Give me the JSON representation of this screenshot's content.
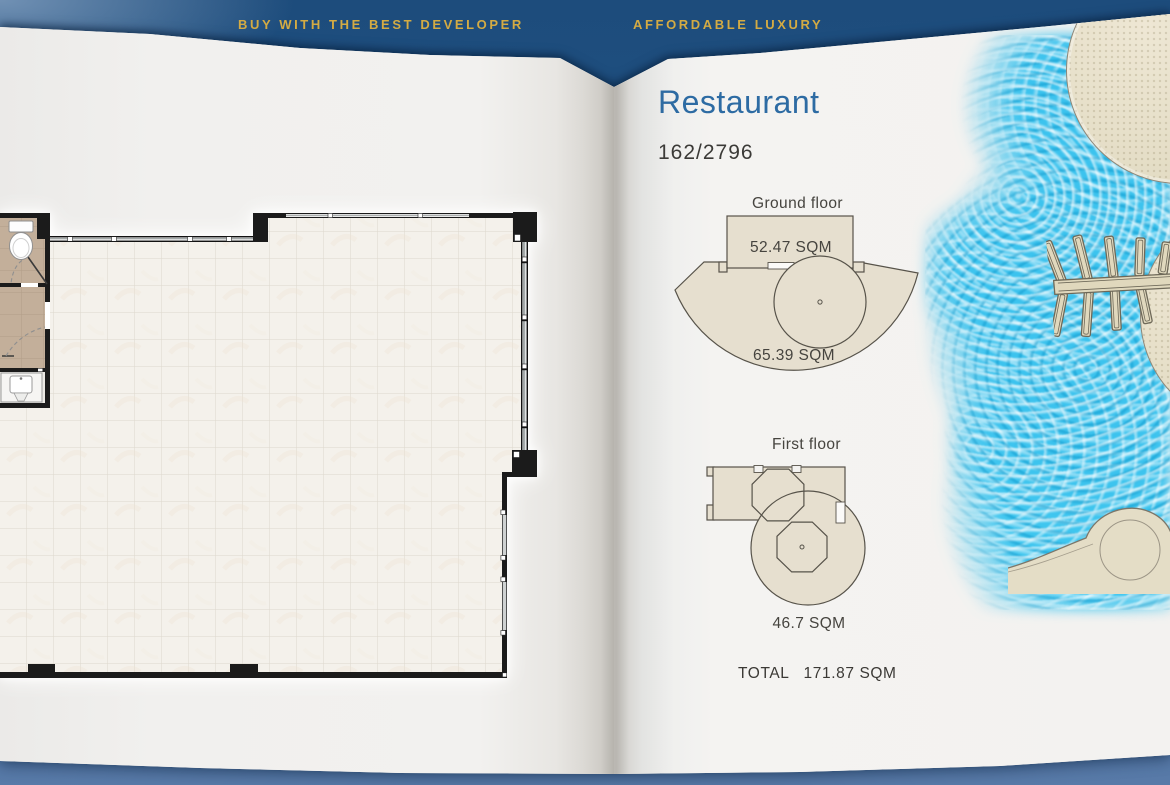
{
  "header": {
    "left_slogan": "BUY WITH THE BEST DEVELOPER",
    "right_slogan": "AFFORDABLE LUXURY"
  },
  "right_page": {
    "title": "Restaurant",
    "unit_number": "162/2796",
    "ground_floor": {
      "label": "Ground floor",
      "upper_area": "52.47 SQM",
      "lower_area": "65.39 SQM"
    },
    "first_floor": {
      "label": "First floor",
      "area": "46.7 SQM"
    },
    "total": {
      "label": "TOTAL",
      "value": "171.87 SQM"
    }
  },
  "left_page": {
    "content": "restaurant unit floor plan drawing",
    "fixtures": [
      "toilet",
      "sink"
    ]
  },
  "colors": {
    "background_blue": "#1e4d7d",
    "background_blue_light": "#5b7aa6",
    "slogan_gold": "#d4ab43",
    "title_blue": "#2d6ba3",
    "page": "#f1f0ee",
    "pool_water": "#3fc6ef",
    "sand": "#e6dfcb",
    "plan_wall": "#1b1b1b",
    "plan_tile": "#f4f1eb",
    "bathroom_tile": "#c3af9a",
    "text_dark": "#3c3a36"
  }
}
